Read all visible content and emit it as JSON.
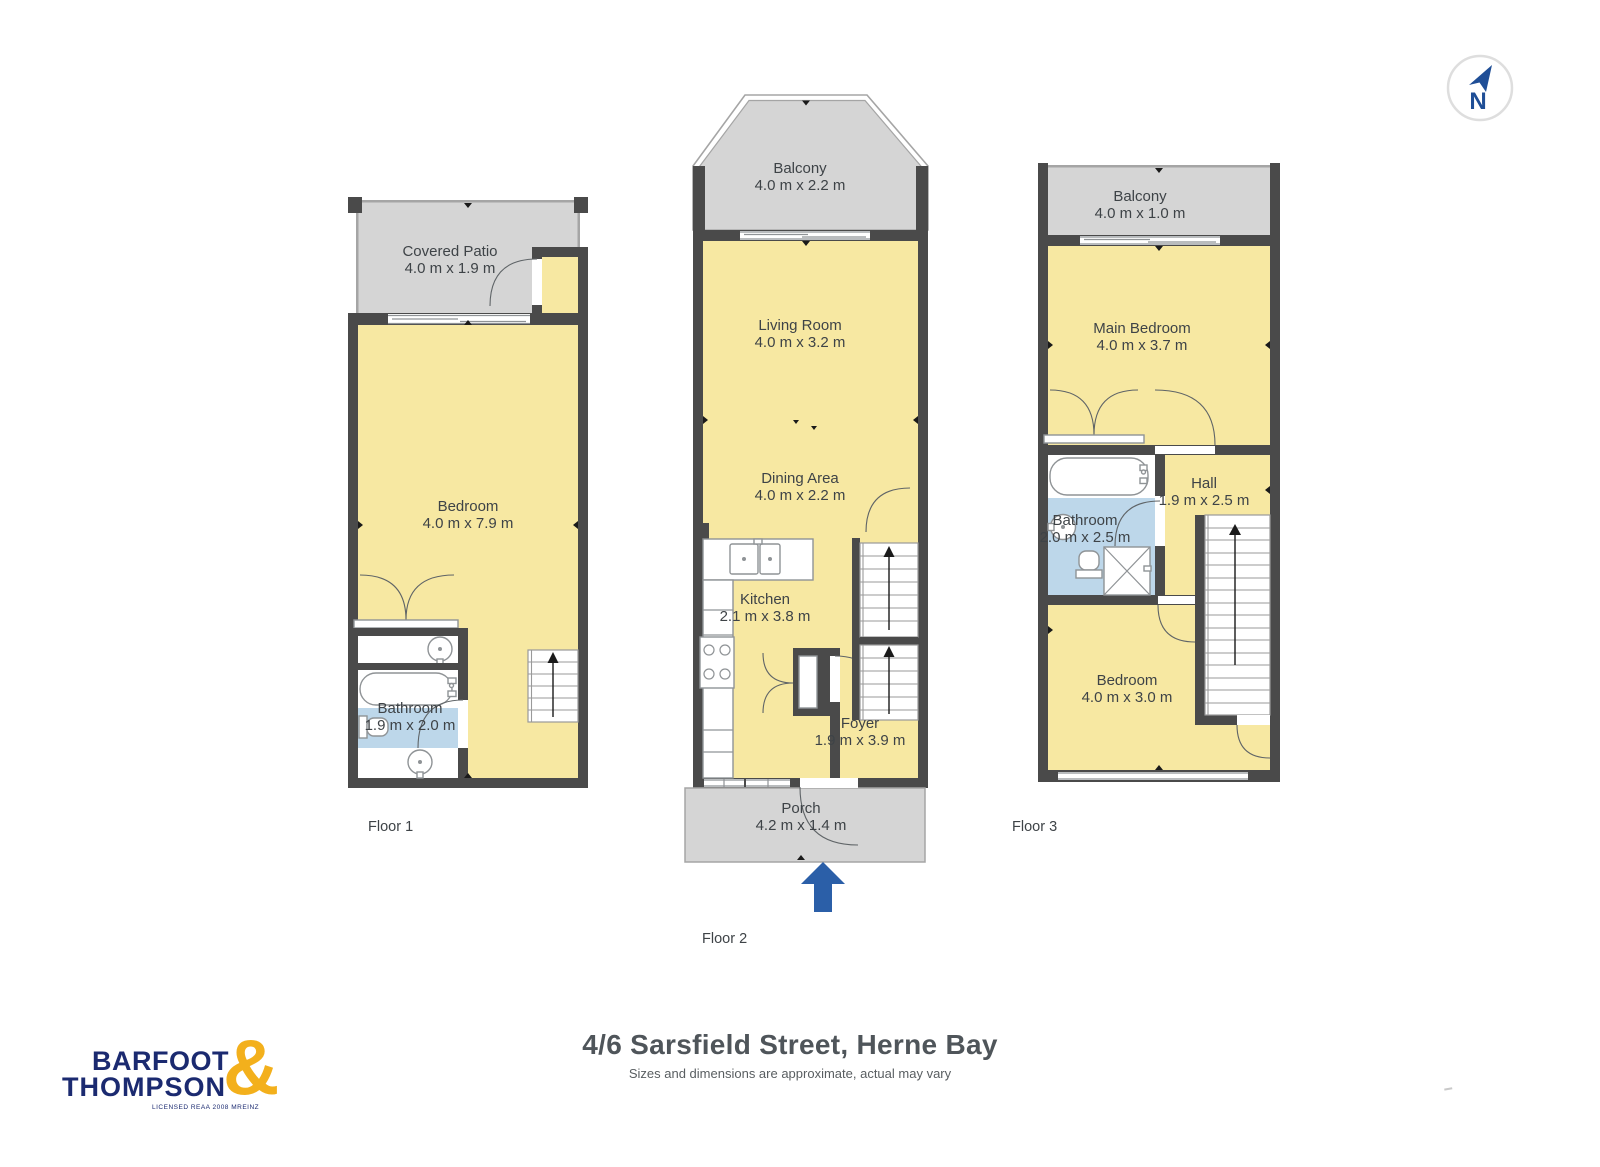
{
  "compass": {
    "letter": "N"
  },
  "floors": [
    {
      "caption": "Floor 1",
      "rooms": [
        {
          "name": "Covered Patio",
          "dims": "4.0 m x 1.9 m"
        },
        {
          "name": "Bedroom",
          "dims": "4.0 m x 7.9 m"
        },
        {
          "name": "Bathroom",
          "dims": "1.9 m x 2.0 m"
        }
      ]
    },
    {
      "caption": "Floor 2",
      "rooms": [
        {
          "name": "Balcony",
          "dims": "4.0 m x 2.2 m"
        },
        {
          "name": "Living Room",
          "dims": "4.0 m x 3.2 m"
        },
        {
          "name": "Dining Area",
          "dims": "4.0 m x 2.2 m"
        },
        {
          "name": "Kitchen",
          "dims": "2.1 m x 3.8 m"
        },
        {
          "name": "Foyer",
          "dims": "1.9 m x 3.9 m"
        },
        {
          "name": "Porch",
          "dims": "4.2 m x 1.4 m"
        }
      ]
    },
    {
      "caption": "Floor 3",
      "rooms": [
        {
          "name": "Balcony",
          "dims": "4.0 m x 1.0 m"
        },
        {
          "name": "Main Bedroom",
          "dims": "4.0 m x 3.7 m"
        },
        {
          "name": "Bathroom",
          "dims": "2.0 m x 2.5 m"
        },
        {
          "name": "Hall",
          "dims": "1.9 m x 2.5 m"
        },
        {
          "name": "Bedroom",
          "dims": "4.0 m x 3.0 m"
        }
      ]
    }
  ],
  "footer": {
    "title": "4/6 Sarsfield Street, Herne Bay",
    "subtitle": "Sizes and dimensions are approximate, actual may vary"
  },
  "branding": {
    "line1": "BARFOOT",
    "line2": "THOMPSON",
    "ampersand": "&",
    "tagline": "LICENSED REAA 2008 MREINZ"
  },
  "colors": {
    "room_fill": "#F7E8A2",
    "outdoor_fill": "#D5D5D5",
    "wall": "#4A4A4A",
    "bathroom_fill": "#BDD7EA",
    "entry_arrow": "#2B5FA8",
    "brand_navy": "#1B2A70",
    "brand_gold": "#F3B01C"
  }
}
